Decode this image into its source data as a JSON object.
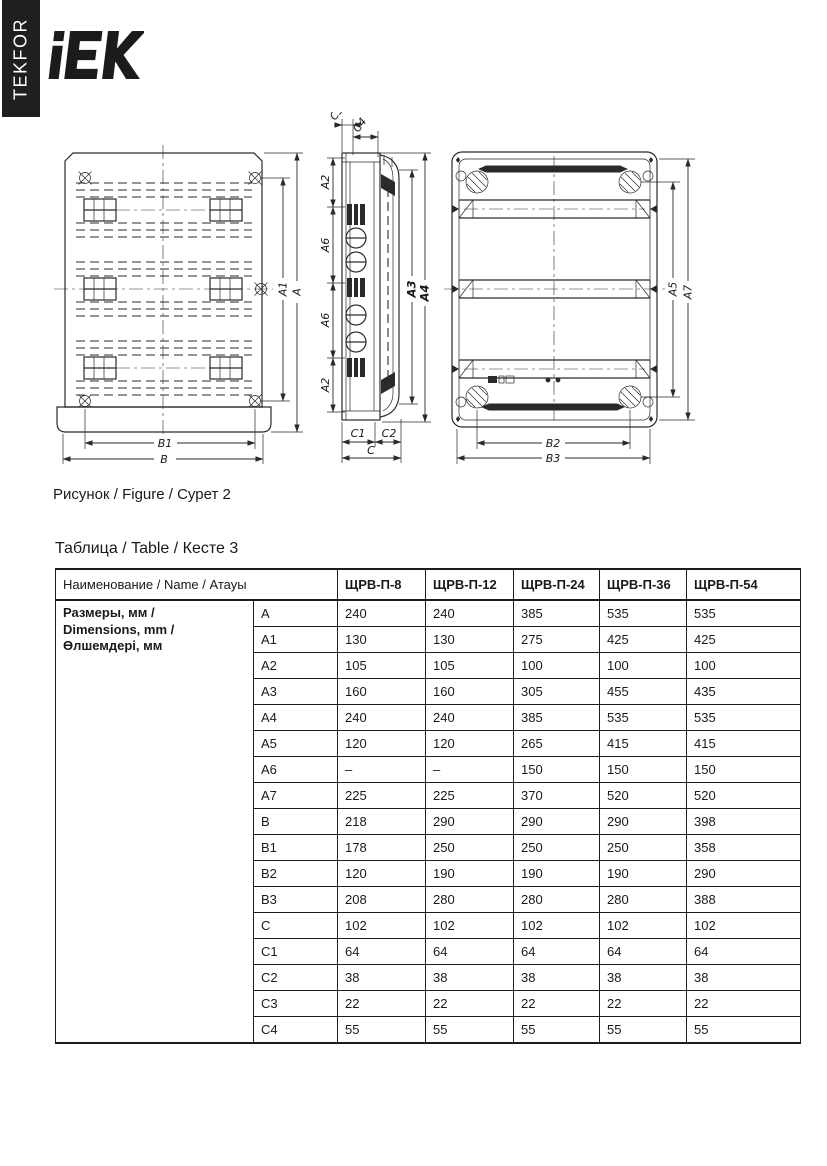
{
  "brand": {
    "sidebar_text": "TEKFOR",
    "logo_text": "IEK"
  },
  "colors": {
    "ink": "#1a1a1a",
    "sidebar_bg": "#211e1e",
    "paper": "#ffffff"
  },
  "figure": {
    "caption": "Рисунок / Figure / Сурет 2",
    "dim_labels": {
      "a": "A",
      "a1": "A1",
      "a2": "A2",
      "a3": "A3",
      "a4": "A4",
      "a5": "A5",
      "a6": "A6",
      "a7": "A7",
      "b": "B",
      "b1": "B1",
      "b2": "B2",
      "b3": "B3",
      "c": "C",
      "c1": "C1",
      "c2": "C2",
      "c3": "C3",
      "c4": "C4"
    }
  },
  "table": {
    "title": "Таблица / Table / Кесте 3",
    "name_header": "Наименование / Name / Атауы",
    "models": [
      "ЩРВ-П-8",
      "ЩРВ-П-12",
      "ЩРВ-П-24",
      "ЩРВ-П-36",
      "ЩРВ-П-54"
    ],
    "group_label_lines": [
      "Размеры, мм /",
      "Dimensions, mm /",
      "Өлшемдері, мм"
    ],
    "rows": [
      {
        "param": "A",
        "values": [
          "240",
          "240",
          "385",
          "535",
          "535"
        ]
      },
      {
        "param": "A1",
        "values": [
          "130",
          "130",
          "275",
          "425",
          "425"
        ]
      },
      {
        "param": "A2",
        "values": [
          "105",
          "105",
          "100",
          "100",
          "100"
        ]
      },
      {
        "param": "A3",
        "values": [
          "160",
          "160",
          "305",
          "455",
          "435"
        ]
      },
      {
        "param": "A4",
        "values": [
          "240",
          "240",
          "385",
          "535",
          "535"
        ]
      },
      {
        "param": "A5",
        "values": [
          "120",
          "120",
          "265",
          "415",
          "415"
        ]
      },
      {
        "param": "A6",
        "values": [
          "–",
          "–",
          "150",
          "150",
          "150"
        ]
      },
      {
        "param": "A7",
        "values": [
          "225",
          "225",
          "370",
          "520",
          "520"
        ]
      },
      {
        "param": "B",
        "values": [
          "218",
          "290",
          "290",
          "290",
          "398"
        ]
      },
      {
        "param": "B1",
        "values": [
          "178",
          "250",
          "250",
          "250",
          "358"
        ]
      },
      {
        "param": "B2",
        "values": [
          "120",
          "190",
          "190",
          "190",
          "290"
        ]
      },
      {
        "param": "B3",
        "values": [
          "208",
          "280",
          "280",
          "280",
          "388"
        ]
      },
      {
        "param": "C",
        "values": [
          "102",
          "102",
          "102",
          "102",
          "102"
        ]
      },
      {
        "param": "C1",
        "values": [
          "64",
          "64",
          "64",
          "64",
          "64"
        ]
      },
      {
        "param": "C2",
        "values": [
          "38",
          "38",
          "38",
          "38",
          "38"
        ]
      },
      {
        "param": "C3",
        "values": [
          "22",
          "22",
          "22",
          "22",
          "22"
        ]
      },
      {
        "param": "C4",
        "values": [
          "55",
          "55",
          "55",
          "55",
          "55"
        ]
      }
    ]
  }
}
